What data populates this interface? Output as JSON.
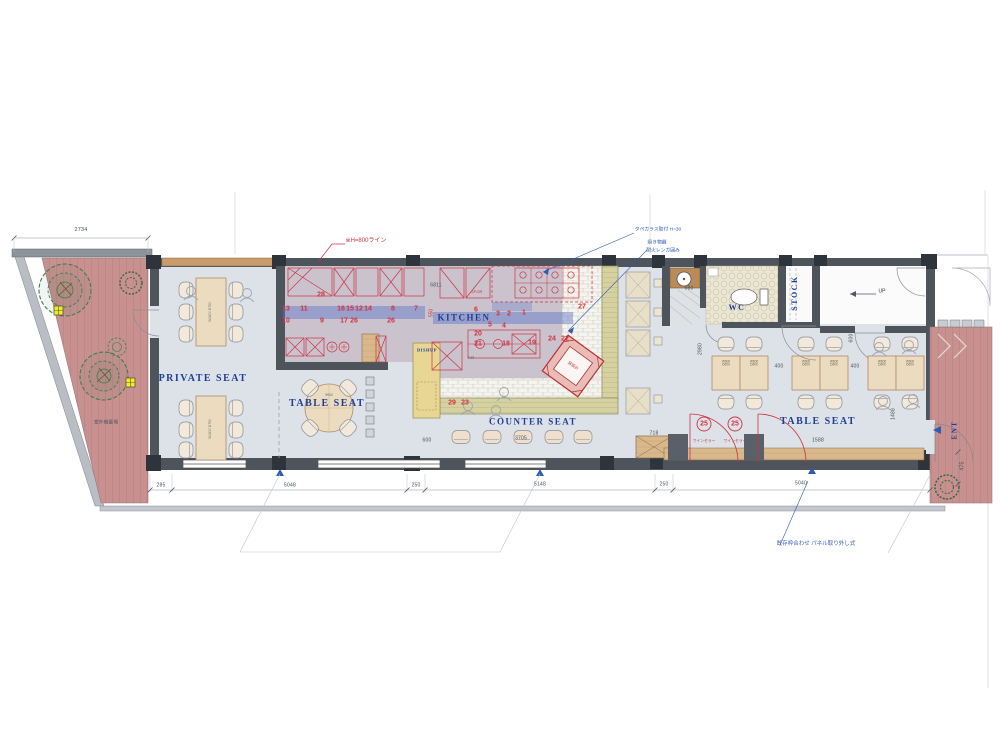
{
  "colors": {
    "label_blue": "#1f3d96",
    "annotation_blue": "#2f5bb5",
    "drawing_red": "#cc3340",
    "deck_pink": "#c8908f",
    "wall_gray": "#4d545c",
    "floor_gray": "#dde2e8",
    "kitchen_floor": "#cac3ce",
    "counter_olive": "#d5d1a0",
    "dishup_yellow": "#e7d694",
    "wood_tan": "#ecdcbf",
    "highlight_blue": "rgba(90,115,200,0.45)"
  },
  "rooms": {
    "private_seat": "PRIVATE SEAT",
    "table_seat_left": "TABLE SEAT",
    "kitchen": "KITCHEN",
    "dishup": "DISHUP",
    "counter_seat": "COUNTER SEAT",
    "wc": "WC",
    "stock": "STOCK",
    "up": "UP",
    "table_seat_right": "TABLE SEAT",
    "ent": "ENT",
    "fr": "F/R"
  },
  "furniture": {
    "private_table": "W1800 D750",
    "small_table": "W600\nD600",
    "round_table": "Φ900",
    "wine_cellar": "ワインセラー",
    "oven": "窯設計",
    "floor2f": "2F/2R"
  },
  "annotations": {
    "h800_line": "※H=800ライン",
    "glass_note": "タペガラス取付 H=30",
    "grill_note": "焼き物器",
    "brick_note": "耐火レンガ囲み",
    "panel_note": "既存枠合わせ パネル取り外し式",
    "outdoor_unit": "室外機置場"
  },
  "numbers": [
    "28",
    "13",
    "11",
    "16",
    "15",
    "12",
    "14",
    "8",
    "7",
    "10",
    "9",
    "17",
    "26",
    "26",
    "6",
    "3",
    "2",
    "1",
    "27",
    "5",
    "4",
    "20",
    "21",
    "18",
    "19",
    "24",
    "22",
    "29",
    "23",
    "25",
    "25"
  ],
  "dims": {
    "t2734": "2734",
    "b285": "285",
    "b5048": "5048",
    "b250a": "250",
    "b5148": "5148",
    "b250b": "250",
    "b5040": "5040",
    "r475": "475",
    "d718": "718",
    "d1588": "1588",
    "d1488": "1488",
    "d400a": "400",
    "d400b": "400",
    "d600a": "600",
    "d600b": "600",
    "d680": "680",
    "d2980": "2980",
    "d3705": "3705",
    "d6811": "6811",
    "d550": "550"
  }
}
